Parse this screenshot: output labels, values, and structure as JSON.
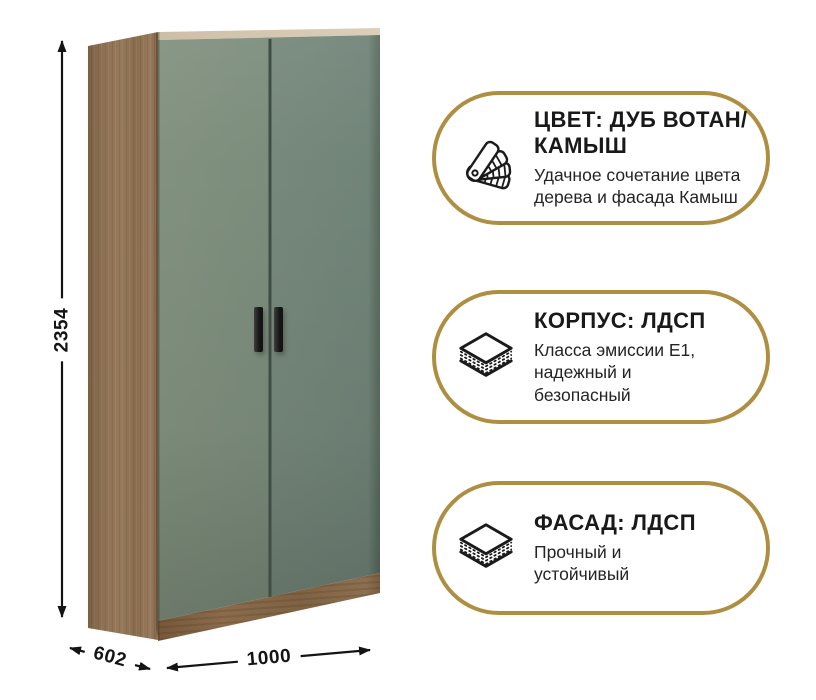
{
  "product": {
    "type_label": "wardrobe-two-door-render",
    "dimensions": {
      "height": "2354",
      "depth": "602",
      "width": "1000"
    }
  },
  "badges": [
    {
      "icon": "color-swatch-fan-icon",
      "title": "ЦВЕТ: ДУБ ВОТАН/\nКАМЫШ",
      "description": "Удачное сочетание цвета\nдерева и фасада Камыш"
    },
    {
      "icon": "layers-icon",
      "title": "КОРПУС: ЛДСП",
      "description": "Класса эмиссии Е1,\nнадежный и\nбезопасный"
    },
    {
      "icon": "layers-icon",
      "title": "ФАСАД: ЛДСП",
      "description": "Прочный и\nустойчивый"
    }
  ],
  "colors": {
    "accent_gold": "#AE8E41",
    "door_green": "#7B8C7D",
    "wood_brown": "#8C7052",
    "text_dark": "#1C1C1C"
  }
}
